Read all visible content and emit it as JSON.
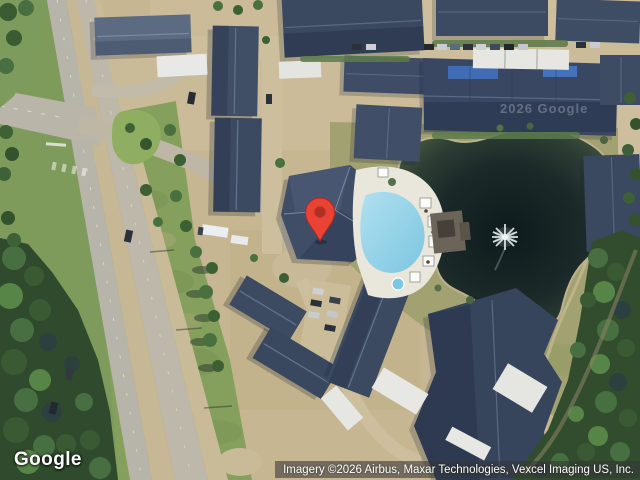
{
  "view": {
    "type": "satellite-map",
    "scene_description": "Aerial imagery of an apartment complex: clubhouse with red map pin beside a fan-shaped resort pool, pond with fountain to the east, divided highway and forest to the west, slate-roofed apartment buildings and white garage rows, dense trees along the right and lower-left edges."
  },
  "branding": {
    "logo_text": "Google"
  },
  "attribution": {
    "text": "Imagery ©2026 Airbus, Maxar Technologies, Vexcel Imaging US, Inc."
  },
  "watermark": {
    "text": "2026 Google"
  },
  "marker": {
    "label": "location-pin",
    "color": "#EA4336",
    "inner_color": "#B03124",
    "tip_x_px": 320,
    "tip_y_px": 240
  },
  "palette": {
    "roof_dark": "#3D4B63",
    "roof_light": "#5C6A82",
    "garage_roof": "#E7E8E4",
    "parking_tan": "#C6B692",
    "road_gray": "#B7B4A9",
    "grass_green": "#84A05C",
    "grass_olive": "#A2A171",
    "tree_green": "#3B5C33",
    "forest_dark": "#2F4A2C",
    "pond_dark": "#13201F",
    "pond_edge": "#45563F",
    "pool_blue": "#8FD2E8",
    "pool_deck": "#E9E6DC",
    "solar_panel_blue": "#3F6CB5"
  }
}
